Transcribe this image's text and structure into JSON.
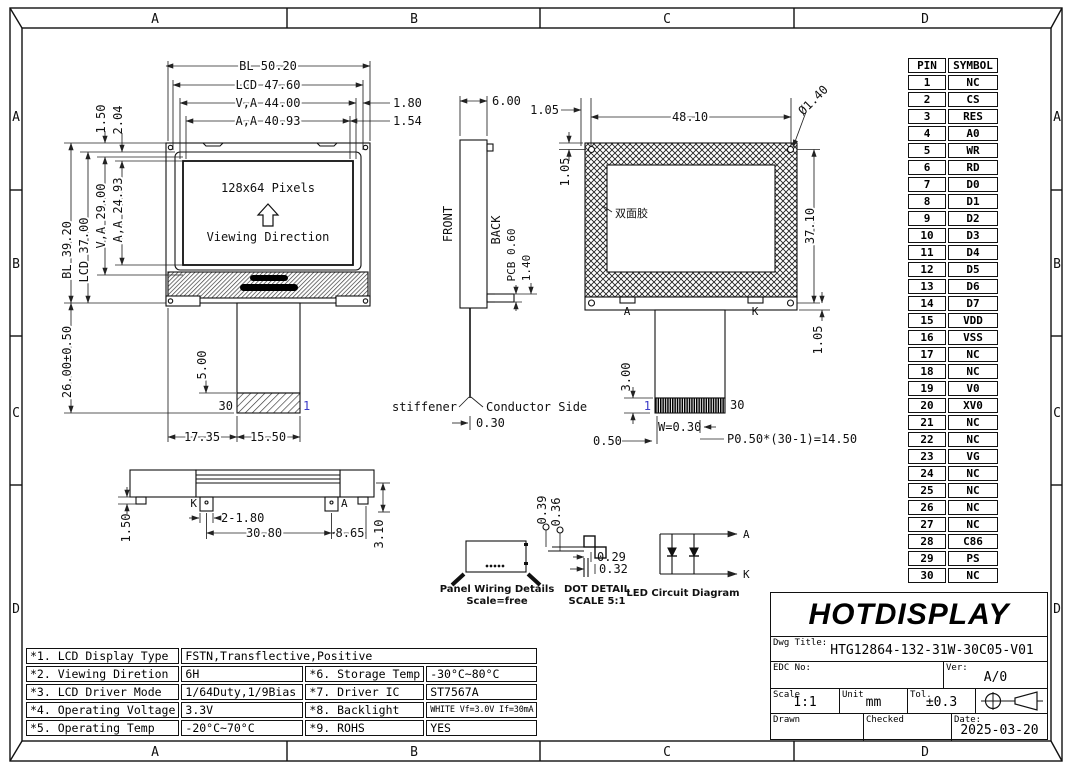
{
  "frame": {
    "zone_labels": [
      "A",
      "B",
      "C",
      "D"
    ]
  },
  "front_view": {
    "display_text": "128x64 Pixels",
    "viewing_text": "Viewing Direction",
    "dim_bl_width": "BL 50.20",
    "dim_lcd_width": "LCD 47.60",
    "dim_va_width": "V,A 44.00",
    "dim_aa_width": "A,A 40.93",
    "dim_1_80": "1.80",
    "dim_1_54": "1.54",
    "dim_1_50": "1.50",
    "dim_2_04": "2.04",
    "dim_bl_height": "BL 39.20",
    "dim_lcd_height": "LCD 37.00",
    "dim_va_height": "V,A 29.00",
    "dim_aa_height": "A,A 24.93",
    "dim_total_height": "26.00±0.50",
    "dim_tail": "5.00",
    "dim_17_35": "17.35",
    "dim_15_50": "15.50",
    "pin_30": "30",
    "pin_1": "1"
  },
  "side_view": {
    "dim_width": "6.00",
    "front_label": "FRONT",
    "back_label": "BACK",
    "pcb_label": "PCB 0.60",
    "dim_1_40": "1.40",
    "stiffener_label": "stiffener",
    "conductor_label": "Conductor Side",
    "dim_0_30": "0.30"
  },
  "back_view": {
    "dim_1_05_top": "1.05",
    "dim_width": "48.10",
    "dim_hole": "Ø1.40",
    "dim_1_05_left": "1.05",
    "tape_label": "双面胶",
    "dim_height": "37.10",
    "dim_1_05_bottom": "1.05",
    "tab_a": "A",
    "tab_k": "K",
    "dim_3_00": "3.00",
    "pin_1": "1",
    "pin_30": "30",
    "dim_w": "W=0.30",
    "dim_0_50": "0.50",
    "dim_pitch": "P0.50*(30-1)=14.50"
  },
  "bottom_view": {
    "dim_1_50": "1.50",
    "pin_k": "K",
    "pin_a": "A",
    "dim_2_1_80": "2-1.80",
    "dim_30_80": "30.80",
    "dim_8_65": "8.65",
    "dim_3_10": "3.10"
  },
  "details": {
    "panel_title": "Panel Wiring Details",
    "panel_scale": "Scale=free",
    "dot_title": "DOT DETAIL",
    "dot_scale": "SCALE 5:1",
    "dim_0_39": "0.39",
    "dim_0_36": "0.36",
    "dim_0_29": "0.29",
    "dim_0_32": "0.32",
    "led_title": "LED Circuit Diagram",
    "led_a": "A",
    "led_k": "K"
  },
  "pin_table": {
    "headers": [
      "PIN",
      "SYMBOL"
    ],
    "rows": [
      {
        "pin": "1",
        "symbol": "NC"
      },
      {
        "pin": "2",
        "symbol": "CS"
      },
      {
        "pin": "3",
        "symbol": "RES"
      },
      {
        "pin": "4",
        "symbol": "A0"
      },
      {
        "pin": "5",
        "symbol": "WR"
      },
      {
        "pin": "6",
        "symbol": "RD"
      },
      {
        "pin": "7",
        "symbol": "D0"
      },
      {
        "pin": "8",
        "symbol": "D1"
      },
      {
        "pin": "9",
        "symbol": "D2"
      },
      {
        "pin": "10",
        "symbol": "D3"
      },
      {
        "pin": "11",
        "symbol": "D4"
      },
      {
        "pin": "12",
        "symbol": "D5"
      },
      {
        "pin": "13",
        "symbol": "D6"
      },
      {
        "pin": "14",
        "symbol": "D7"
      },
      {
        "pin": "15",
        "symbol": "VDD"
      },
      {
        "pin": "16",
        "symbol": "VSS"
      },
      {
        "pin": "17",
        "symbol": "NC"
      },
      {
        "pin": "18",
        "symbol": "NC"
      },
      {
        "pin": "19",
        "symbol": "V0"
      },
      {
        "pin": "20",
        "symbol": "XV0"
      },
      {
        "pin": "21",
        "symbol": "NC"
      },
      {
        "pin": "22",
        "symbol": "NC"
      },
      {
        "pin": "23",
        "symbol": "VG"
      },
      {
        "pin": "24",
        "symbol": "NC"
      },
      {
        "pin": "25",
        "symbol": "NC"
      },
      {
        "pin": "26",
        "symbol": "NC"
      },
      {
        "pin": "27",
        "symbol": "NC"
      },
      {
        "pin": "28",
        "symbol": "C86"
      },
      {
        "pin": "29",
        "symbol": "PS"
      },
      {
        "pin": "30",
        "symbol": "NC"
      }
    ]
  },
  "title_block": {
    "logo": "HOTDISPLAY",
    "dwg_title_label": "Dwg Title:",
    "dwg_title": "HTG12864-132-31W-30C05-V01",
    "edc_label": "EDC No:",
    "ver_label": "Ver:",
    "ver_value": "A/0",
    "scale_label": "Scale",
    "scale_value": "1:1",
    "unit_label": "Unit",
    "unit_value": "mm",
    "tol_label": "Tol.",
    "tol_value": "±0.3",
    "drawn_label": "Drawn",
    "checked_label": "Checked",
    "date_label": "Date:",
    "date_value": "2025-03-20"
  },
  "spec_table": {
    "items": [
      {
        "label": "*1. LCD Display Type",
        "value": "FSTN,Transflective,Positive"
      },
      {
        "label": "*2. Viewing Diretion",
        "value": "6H"
      },
      {
        "label": "*3. LCD Driver Mode",
        "value": "1/64Duty,1/9Bias"
      },
      {
        "label": "*4. Operating Voltage",
        "value": "3.3V"
      },
      {
        "label": "*5. Operating Temp",
        "value": "-20°C~70°C"
      },
      {
        "label": "*6. Storage Temp",
        "value": "-30°C~80°C"
      },
      {
        "label": "*7. Driver IC",
        "value": "ST7567A"
      },
      {
        "label": "*8. Backlight",
        "value": "WHITE Vf=3.0V If=30mA"
      },
      {
        "label": "*9. ROHS",
        "value": "YES"
      }
    ]
  }
}
